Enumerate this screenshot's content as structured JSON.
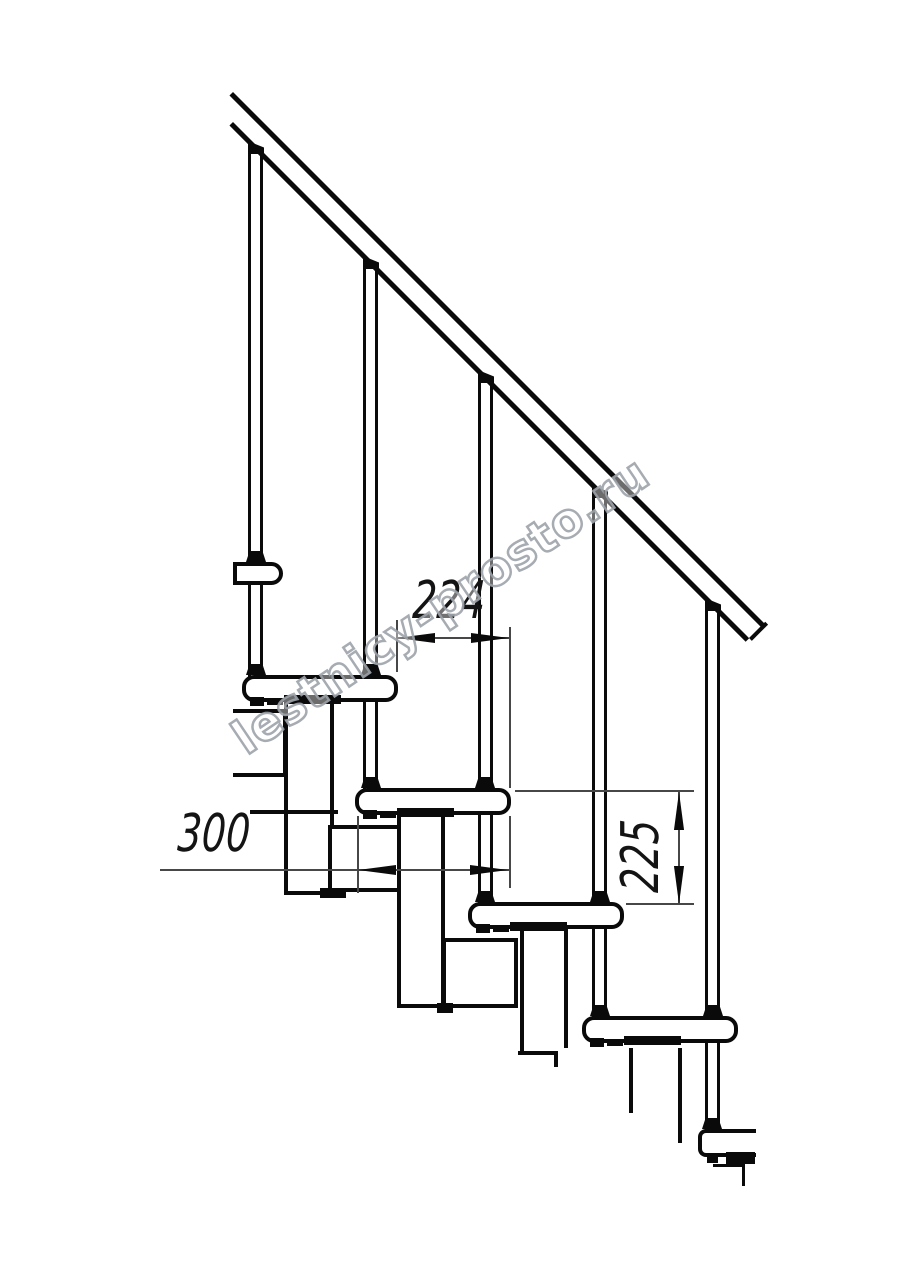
{
  "page": {
    "background": "#ffffff",
    "type": "technical-drawing",
    "subject": "modular staircase side elevation"
  },
  "watermark": {
    "text": "lestnicy-prosto.ru",
    "color": "#9ca3aa"
  },
  "dimensions": {
    "d224": {
      "value": "224",
      "orientation": "horizontal"
    },
    "d300": {
      "value": "300",
      "orientation": "horizontal"
    },
    "d225": {
      "value": "225",
      "orientation": "vertical"
    }
  },
  "components": {
    "balusters": 5,
    "treads": 5,
    "handrail": 1,
    "line_color": "#0a0a0a",
    "dim_line_color": "#474747"
  }
}
